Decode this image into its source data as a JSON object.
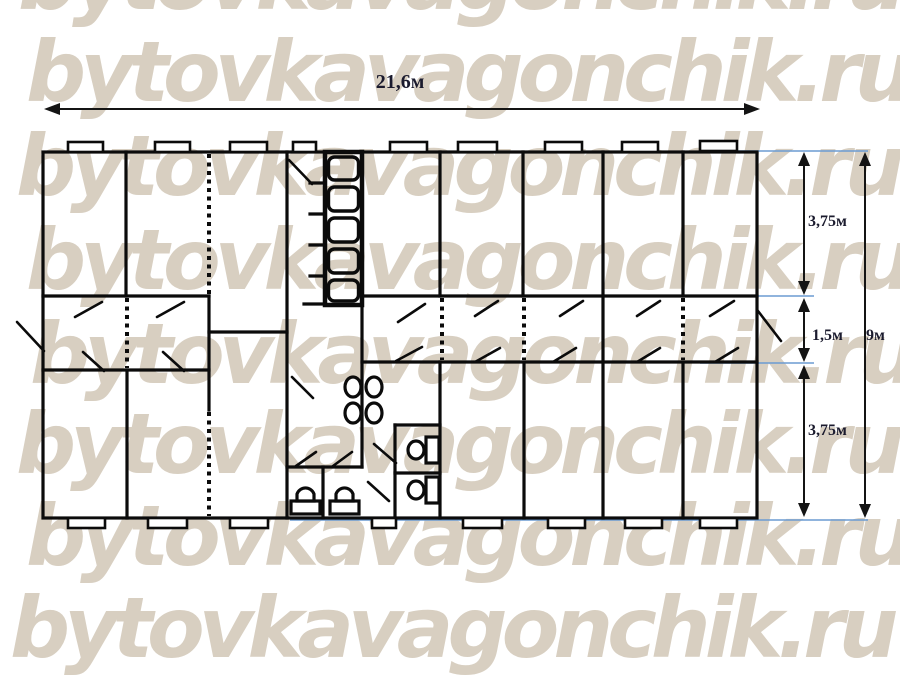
{
  "watermark": {
    "text": "bytovkavagonchik.ru",
    "color": "#d8cfc1",
    "rows": 8
  },
  "dimensions": {
    "total_width": "21,6м",
    "upper_rooms_depth": "3,75м",
    "corridor_depth": "1,5м",
    "lower_rooms_depth": "3,75м",
    "total_depth": "9м"
  },
  "plan": {
    "kind": "modular-building-floor-plan",
    "legend": {
      "window-icon": "rectangle protruding from exterior wall",
      "door-swing-icon": "diagonal leaf line",
      "staircase-icon": "stacked step boxes, 5 steps",
      "washbasin-icon": "oval bowl, 4 total",
      "toilet-icon": "tank rectangle with bowl, 2 total",
      "washstand-icon": "arched bowl on base, 2 total",
      "partition-dotted-icon": "dotted line = light partition"
    },
    "counts": {
      "windows_top": 9,
      "windows_bottom": 8,
      "door_swings": 21,
      "stair_steps": 5,
      "washbasins": 4,
      "toilets": 2,
      "washstands": 2
    }
  },
  "colors": {
    "background": "#ffffff",
    "plan_lines": "#0b0b0b",
    "watermark": "#d8cfc1",
    "dimension_guides_blue": "#6b9bd2",
    "dimension_text": "#1b1b2e"
  }
}
